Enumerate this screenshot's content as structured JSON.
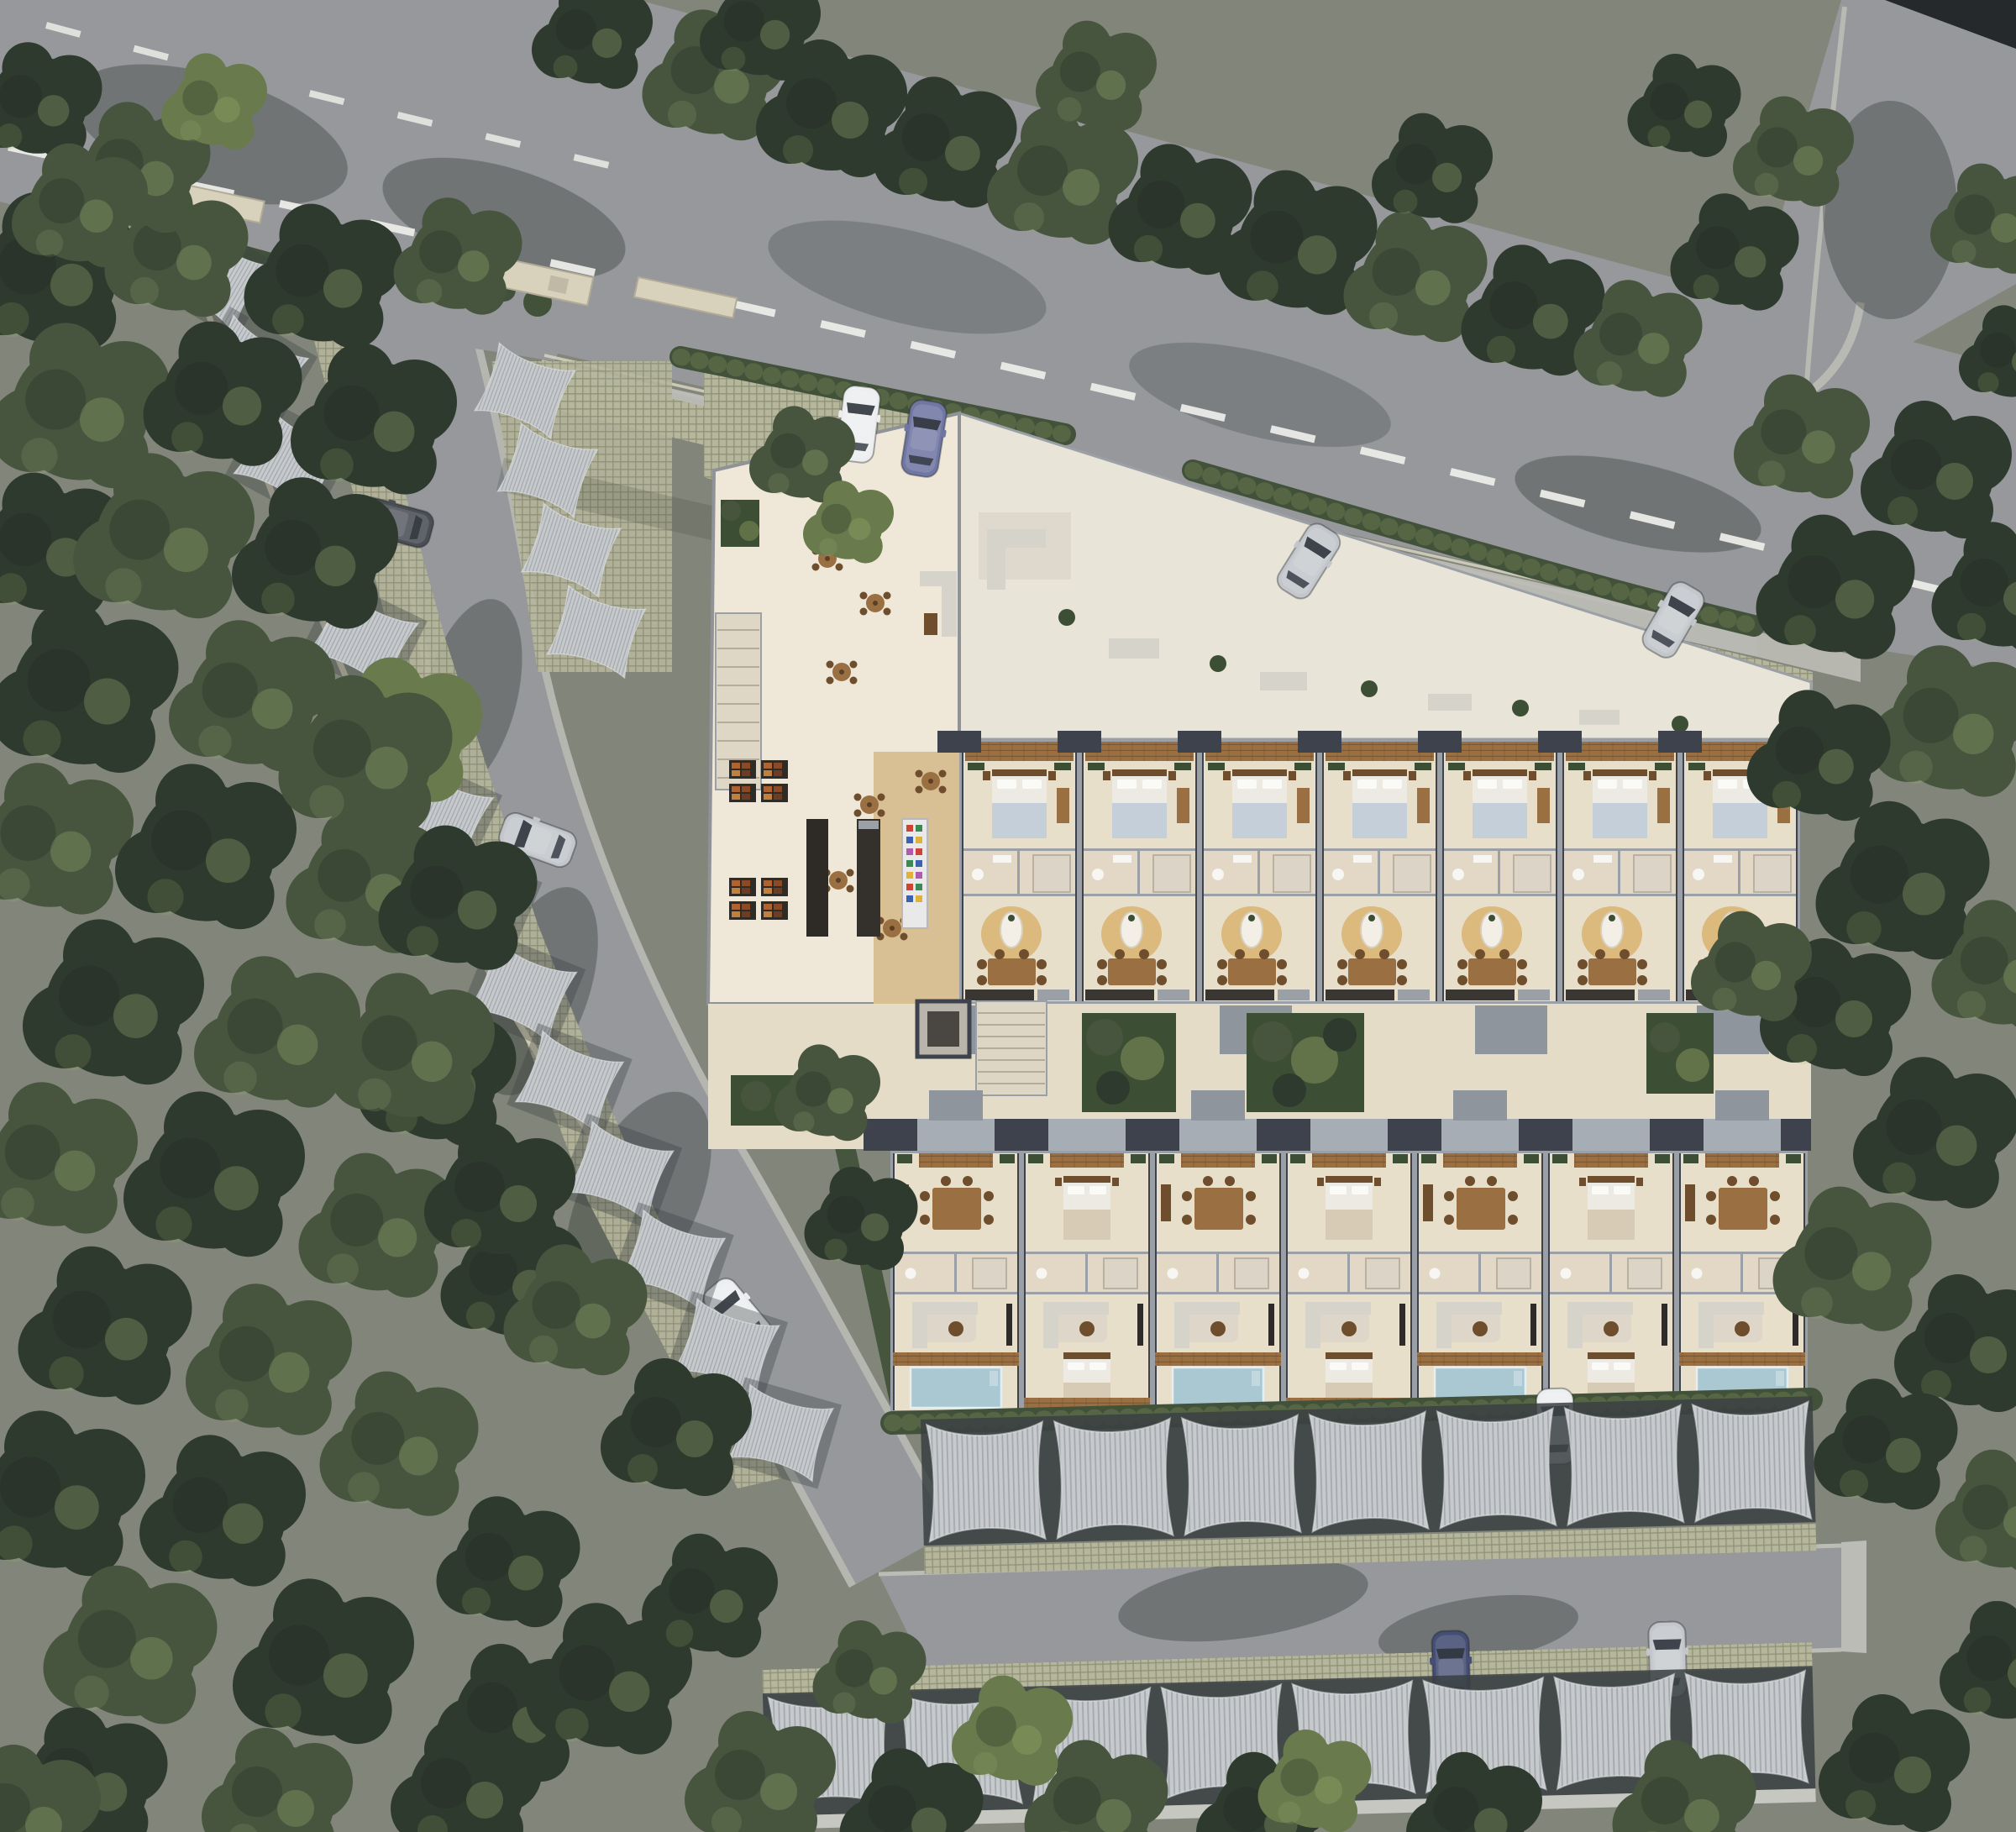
{
  "scene": {
    "kind": "aerial architectural rendering",
    "view": "top-down site plan of a residential resort development surrounded by forest",
    "text_visible": "none"
  },
  "palette": {
    "ground": "#82867a",
    "asphalt": "#96989c",
    "asphaltDark": "#6e7176",
    "roadLine": "#ebece8",
    "roadEdge": "#c4c4be",
    "curb": "#bcbcb6",
    "grasscrete": "#b5b69c",
    "grasscreteDot": "#8f9177",
    "hedge": "#42523a",
    "planter": "#3c4e33",
    "forestDark": "#2e3a2e",
    "forestMid": "#47553f",
    "forestLight": "#697a4d",
    "leafHighlight": "#9db46f",
    "treeShadow": "#20291f",
    "canopy": "#c7cacd",
    "canopyStripe": "#8d9398",
    "canopyGap": "#3a3f42",
    "wallLine": "#9ba0a6",
    "roofDark": "#3d424c",
    "roofMid": "#8e959d",
    "floorPale": "#efe8d8",
    "floorTravertine": "#e8dfcb",
    "bathFloor": "#e2d8c5",
    "plaza": "#e5dcc7",
    "woodFloor": "#d8c094",
    "wood": "#9a6f42",
    "woodDark": "#6e4e2d",
    "rug": "#dcb97c",
    "pool": "#a9c8d2",
    "bedWhite": "#eceae3",
    "bedBlue": "#c5cfda",
    "bedTan": "#d8cbb6",
    "sofa": "#d6d3ca",
    "counterDark": "#3a3632",
    "steel": "#9aa0a6",
    "gateWall": "#d8d1bc",
    "boundaryWall": "#d3ccb6",
    "blackCorner": "#26292b"
  },
  "site": {
    "roads": {
      "main_road": {
        "direction": "diagonal, upper area",
        "marking": "white dashed centerline",
        "edge_marking": "double line at south curb"
      },
      "branch_road": {
        "location": "top-right corner junction"
      },
      "internal_driveway": {
        "route": "from gated entrance curving south to parking court"
      },
      "south_parking_aisle": {
        "location": "between the two south canopy rows"
      }
    },
    "buildings": {
      "amenity_building": {
        "features": [
          "entry terrace with round cafe tables",
          "lounge sofas",
          "stair",
          "market shelving",
          "bar counters",
          "retail fridge with colorful goods",
          "wood cafe floor"
        ]
      },
      "upper_wing": {
        "units": 7,
        "unit_rooms": [
          "wood balcony",
          "bedroom",
          "bathroom",
          "dining-living with oval rug",
          "kitchen"
        ],
        "north_strip": "outdoor lounge terrace on permeable pavers"
      },
      "lower_wing": {
        "units": 7,
        "plunge_pools": 4,
        "unit_rooms": [
          "entry deck",
          "bedroom or dining",
          "bathroom",
          "living room",
          "pool terrace or second bedroom"
        ]
      },
      "courtyard": {
        "planters": 3,
        "circulation": [
          "elevator shaft",
          "staircase"
        ]
      }
    },
    "parking": {
      "shade_sail_rows": {
        "west_driveway_row": 14,
        "entrance_side_row": 4,
        "south_row_1": 7,
        "south_row_2": 8
      },
      "surface": "khaki permeable grid pavers"
    },
    "vehicles": [
      {
        "color_name": "white",
        "hex": "#eceeef",
        "location": "entrance forecourt"
      },
      {
        "color_name": "blue-violet",
        "hex": "#7077a3",
        "location": "entrance forecourt"
      },
      {
        "color_name": "silver",
        "hex": "#c3c7cb",
        "location": "north paver strip, centre"
      },
      {
        "color_name": "silver",
        "hex": "#c3c7cb",
        "location": "north paver strip, east"
      },
      {
        "color_name": "dark-gray",
        "hex": "#4a4e55",
        "location": "west canopy row, top"
      },
      {
        "color_name": "silver",
        "hex": "#c3c7cb",
        "location": "west canopy row, middle"
      },
      {
        "color_name": "white",
        "hex": "#eceeef",
        "location": "west canopy row, lower"
      },
      {
        "color_name": "white",
        "hex": "#eceeef",
        "location": "south canopy row 1"
      },
      {
        "color_name": "dark-blue",
        "hex": "#454e74",
        "location": "south canopy row 2"
      },
      {
        "color_name": "silver",
        "hex": "#c3c7cb",
        "location": "south canopy row 2"
      }
    ],
    "vegetation": {
      "forest": "dense tree canopy bounding the site on west, north, east and south",
      "hedges": [
        "along main-road frontage",
        "entrance shrubs",
        "behind south units",
        "beside internal driveway"
      ],
      "courtyard_planters": "tropical foliage beds between wings"
    }
  }
}
